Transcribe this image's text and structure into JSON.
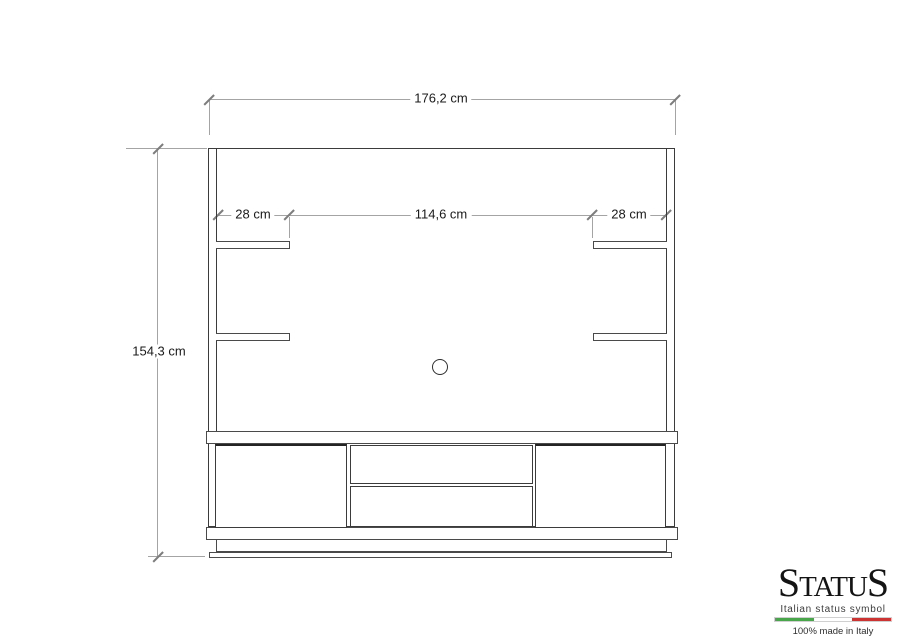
{
  "dimensions": {
    "overall_width": "176,2 cm",
    "overall_height": "154,3 cm",
    "left_shelf_width": "28 cm",
    "center_width": "114,6 cm",
    "right_shelf_width": "28 cm"
  },
  "logo": {
    "brand_first": "S",
    "brand_mid": "TATU",
    "brand_last": "S",
    "tagline": "Italian status symbol",
    "made_in": "100% made in Italy",
    "flag_green": "#4aa64a",
    "flag_white": "#ffffff",
    "flag_red": "#cc3333"
  },
  "colors": {
    "outline": "#3b3b3b",
    "dimension_line": "#a4a4a4",
    "label_text": "#1a1a1a",
    "background": "#ffffff"
  }
}
